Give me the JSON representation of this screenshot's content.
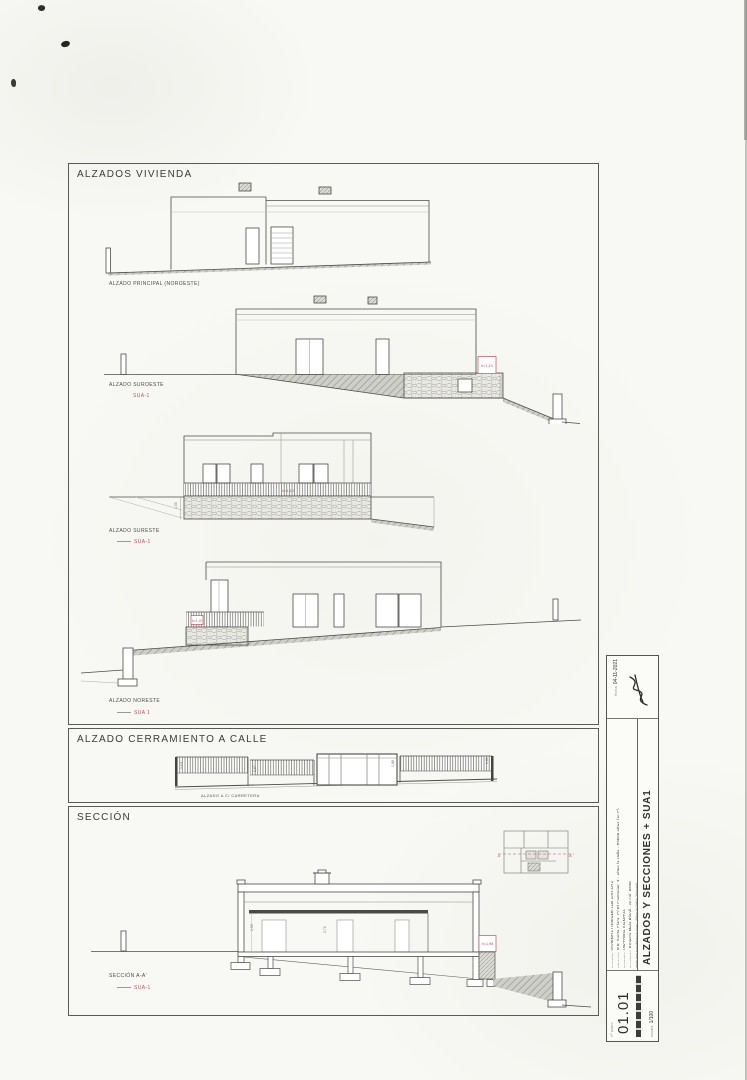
{
  "sheet": {
    "ink": "#4a4a46",
    "accent_red": "#c05060"
  },
  "frames": {
    "alzados": {
      "title": "ALZADOS VIVIENDA",
      "e1": {
        "label": "ALZADO PRINCIPAL (NOROESTE)"
      },
      "e2": {
        "label": "ALZADO SUROESTE",
        "code": "SUA-1",
        "marker": "h=1,10"
      },
      "e3": {
        "label": "ALZADO SURESTE",
        "code": "SUA-1",
        "marker": "h=1,10",
        "dim_left": "1,50"
      },
      "e4": {
        "label": "ALZADO NORESTE",
        "code": "SUA 1",
        "marker": "h=1,10"
      }
    },
    "cerramiento": {
      "title": "ALZADO CERRAMIENTO A CALLE",
      "label": "ALZADO A C/ CARRETERA",
      "dims": {
        "d1": "1,13",
        "d2": "0,67",
        "d3": "1,88",
        "d4": "1,01"
      }
    },
    "seccion": {
      "title": "SECCIÓN",
      "label": "SECCIÓN A-A'",
      "code": "SUA-1",
      "marker": "h=1,98",
      "dim1": "2,50",
      "dim2": "2,70",
      "plan_key": {
        "left_mark": "A",
        "right_mark": "A'"
      }
    }
  },
  "titleblock": {
    "sheet_number_label": "nº plano",
    "sheet_number": "01.01",
    "scale_label": "escala",
    "scale_value": "1/100",
    "date_label": "fecha",
    "date_value": "04-11-2021",
    "sheet_title": "ALZADOS Y SECCIONES + SUA1",
    "fields": {
      "proyecto_label": "proyecto",
      "proyecto": "VIVIENDA UNIFAMILIAR AISLADA",
      "situacion_label": "situación",
      "situacion": "P.P. Santa Clara, C/ El Cantonier, 3 · Altea la Vella · 03599 Altea (ALC)",
      "promotor_label": "promotor",
      "promotor": "VIKTORIA IVANOVA",
      "arquitecto_label": "arquitecto",
      "arquitecto": "Ernesto Mela Ripoll · nº col. 8936",
      "contacto": "www.emrarquitectura.com · Altea la Vella (Alacant)"
    }
  }
}
